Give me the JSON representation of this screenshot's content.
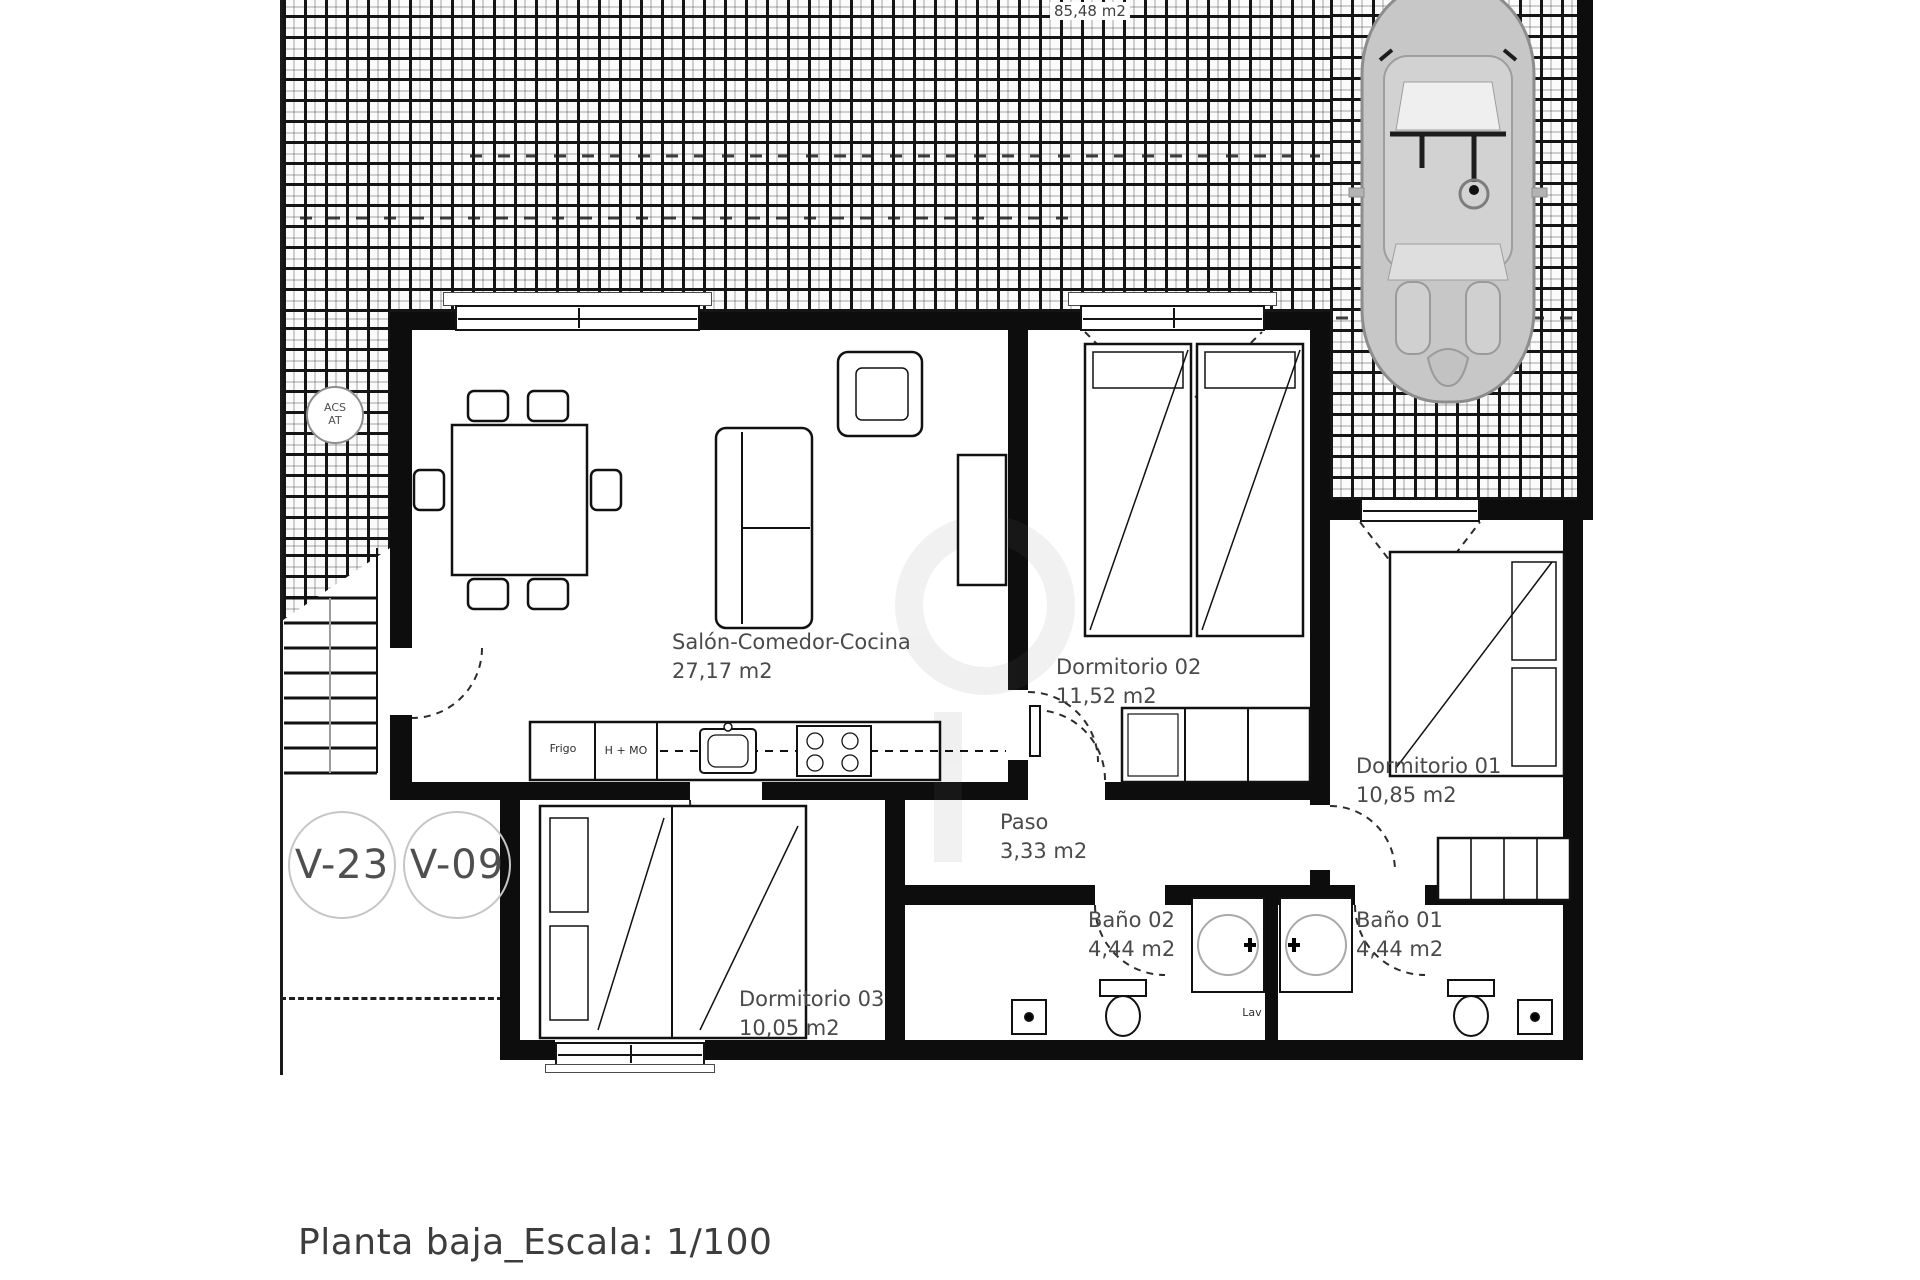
{
  "page": {
    "title": "Planta baja_Escala: 1/100"
  },
  "terrace": {
    "area_label": "85,48 m2"
  },
  "rooms": {
    "salon": {
      "name": "Salón-Comedor-Cocina",
      "area": "27,17 m2"
    },
    "dorm02": {
      "name": "Dormitorio 02",
      "area": "11,52 m2"
    },
    "dorm01": {
      "name": "Dormitorio 01",
      "area": "10,85 m2"
    },
    "dorm03": {
      "name": "Dormitorio 03",
      "area": "10,05 m2"
    },
    "paso": {
      "name": "Paso",
      "area": "3,33 m2"
    },
    "bano02": {
      "name": "Baño 02",
      "area": "4,44 m2"
    },
    "bano01": {
      "name": "Baño 01",
      "area": "4,44 m2"
    }
  },
  "markers": {
    "window_left": "V-23",
    "window_right": "V-09",
    "acs": {
      "line1": "ACS",
      "line2": "AT"
    }
  },
  "fixtures": {
    "fridge": "Frigo",
    "oven_micro": "H + MO",
    "washbasin": "Lav"
  },
  "colors": {
    "wall": "#0d0d0d",
    "label_text": "#4a4a4a",
    "car_body": "#c7c7c7",
    "marker_border": "#c6c6c6"
  }
}
